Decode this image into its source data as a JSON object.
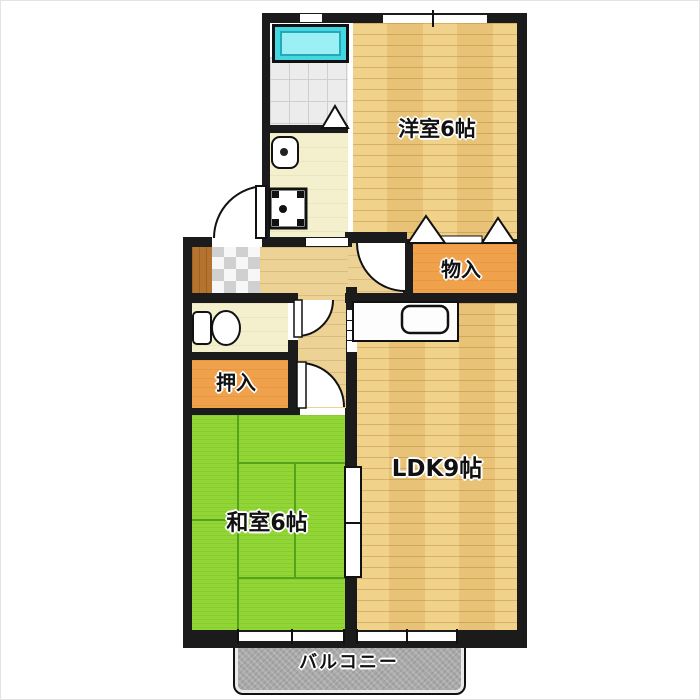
{
  "plan": {
    "type": "apartment-floor-plan",
    "rooms": {
      "western_room": {
        "label": "洋室6帖"
      },
      "storage": {
        "label": "物入"
      },
      "ldk": {
        "label": "LDK9帖"
      },
      "closet": {
        "label": "押入"
      },
      "japanese_room": {
        "label": "和室6帖"
      },
      "balcony": {
        "label": "バルコニー"
      }
    },
    "fixtures": [
      "bathtub-icon",
      "bathroom-tile-floor",
      "washbasin-icon",
      "washing-machine-pan-icon",
      "toilet-icon",
      "kitchen-counter",
      "kitchen-sink-icon",
      "entrance-tile",
      "entrance-step",
      "door-swing-arc",
      "folding-door-triangle",
      "sliding-door",
      "window",
      "fusuma-doors"
    ],
    "colors": {
      "wall": "#1b1b1b",
      "wood_floor": "#edc97d",
      "hall_floor": "#ecd295",
      "pale_floor": "#f4efcd",
      "closet_orange": "#f0a14b",
      "tatami_green": "#92d636",
      "tatami_line": "#55a31d",
      "bathtub_cyan": "#43d7e2",
      "balcony_gray": "#a9a9a9"
    }
  }
}
